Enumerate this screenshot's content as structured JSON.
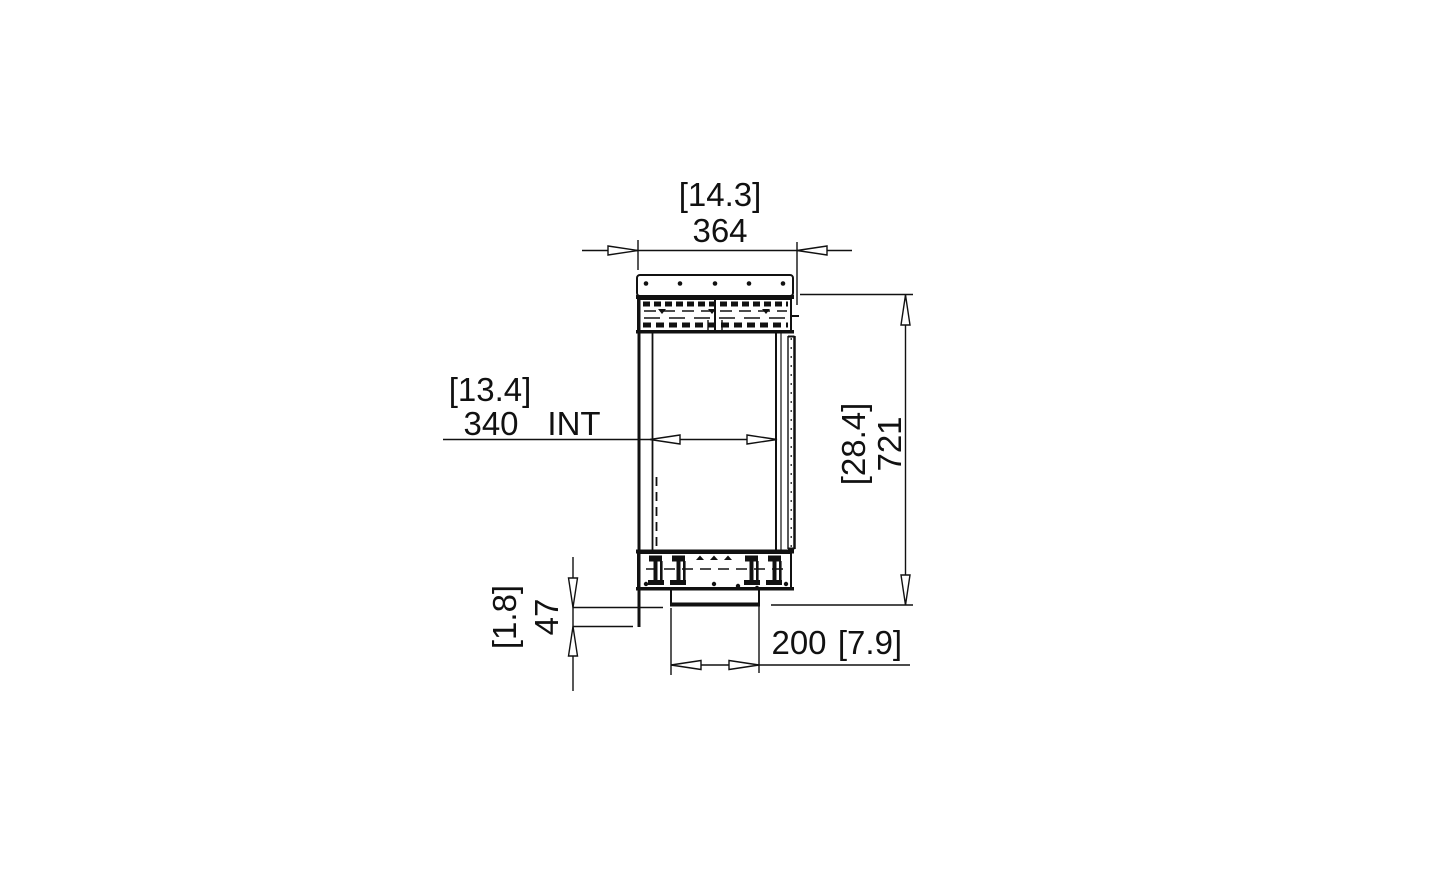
{
  "drawing": {
    "background_color": "#ffffff",
    "line_color": "#111111",
    "dimensions": {
      "overall_width": {
        "alt": "[14.3]",
        "value": "364"
      },
      "internal_width": {
        "alt": "[13.4]",
        "value": "340",
        "suffix": "INT"
      },
      "overall_height": {
        "alt": "[28.4]",
        "value": "721"
      },
      "bottom_offset": {
        "alt": "[1.8]",
        "value": "47"
      },
      "burner_width": {
        "value": "200",
        "alt": "[7.9]"
      }
    }
  }
}
